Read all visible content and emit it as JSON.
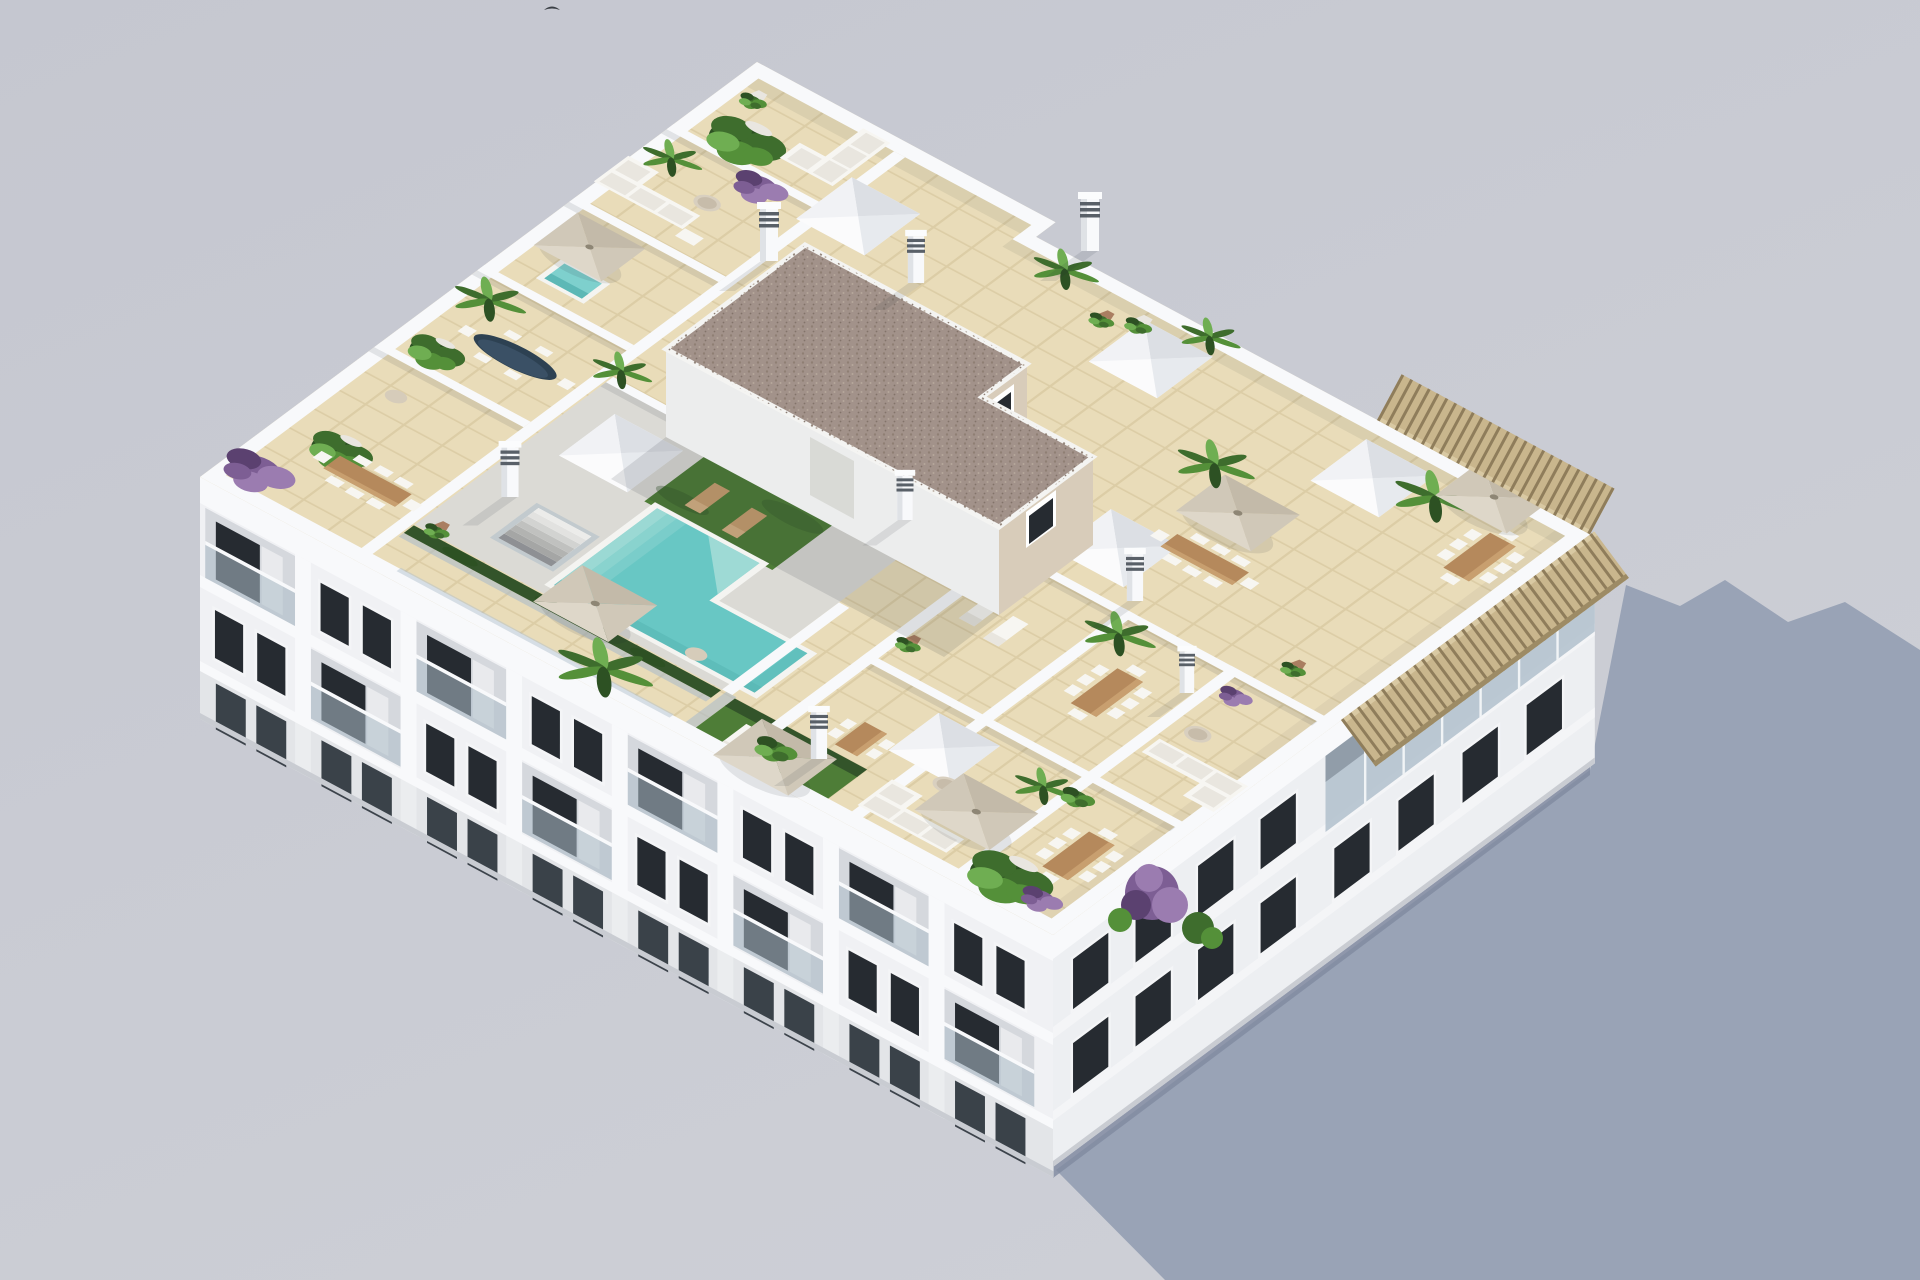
{
  "meta": {
    "description": "Aerial 3D architectural rendering of a white Mediterranean apartment block seen from above: landscaped rooftop with swimming pool, sun-deck, glass-fenced solarium, private tiled terraces with parasols, dining sets, sofas and planters; stair core with gravel roof and skylight wells; long blue-grey building shadow cast on the pale ground to the right.",
    "image_type": "photorealistic 3d render, isometric aerial view",
    "canvas": "1920x1280"
  },
  "palette": {
    "bg_top": "#c5c7d0",
    "bg_bottom": "#cdcfd6",
    "shadow": "#95a0b3",
    "white_hi": "#f8f9fb",
    "white": "#f0f1f4",
    "white_low": "#e2e4e9",
    "recess": "#d5d8dd",
    "window": "#262b31",
    "window_lt": "#3c434b",
    "frame": "#f4f5f7",
    "glassrail": "#adbdc9",
    "curtain": "#e9eaed",
    "tile": "#e9dcb9",
    "tile_line": "#d9c9a1",
    "pooldeck": "#dbdad5",
    "pool": "#68c7c4",
    "pool_lt": "#a4dcd7",
    "pool_dk": "#55b5b3",
    "coping": "#f4f4f1",
    "grass": "#4e7d37",
    "hedge": "#33542a",
    "gravel": "#a2928a",
    "core_wall": "#d8ccba",
    "core_wall_lt": "#e7decd",
    "core_white": "#eceded",
    "wood": "#b5895c",
    "wood_lt": "#c89f6f",
    "pergola": "#c9b68d",
    "pergola_slat": "#8f7d5b",
    "umb_a": "#ded7c9",
    "umb_b": "#d0c8b8",
    "umb_c": "#c3baa9",
    "furn": "#f7f6f2",
    "cushion": "#e9e6df",
    "green_d": "#2d5123",
    "green_m": "#3e6d2d",
    "green_l": "#549039",
    "green_xl": "#6fae52",
    "purple": "#7d5e94",
    "purple_d": "#5b4170",
    "purple_l": "#9b7cb0",
    "pot": "#aa7e61",
    "pot_w": "#e9e6e0",
    "table_dark": "#2d4152",
    "jacuzzi": "#7ed0cd",
    "bird": "#3a3f45"
  },
  "scene": {
    "building": {
      "view": "rooftop seen from high oblique angle",
      "facades_visible": [
        "southwest facade with recessed balconies and glass railings",
        "southeast facade with window grid and timber pergola near the corner"
      ],
      "roof_floor": "beige terracotta tile terraces with white dividing walls"
    },
    "rooftop_amenities": [
      "L-shaped swimming pool with steps",
      "artificial-grass sunbathing lawns",
      "glass pool fence with dark hedge",
      "stair core with gravel flat roof",
      "pyramid skylight wells",
      "ventilation chimneys",
      "beige cantilever parasols",
      "timber dining sets with white chairs",
      "white outdoor lounge sofas",
      "sun loungers",
      "hot tub",
      "potted palms, olive trees and bougainvillea"
    ],
    "counts": {
      "parasols": 6,
      "skylights": 6,
      "dining_sets": 7,
      "vent_chimneys": 8,
      "sun_loungers": 6,
      "outdoor_sofas": 4
    }
  }
}
